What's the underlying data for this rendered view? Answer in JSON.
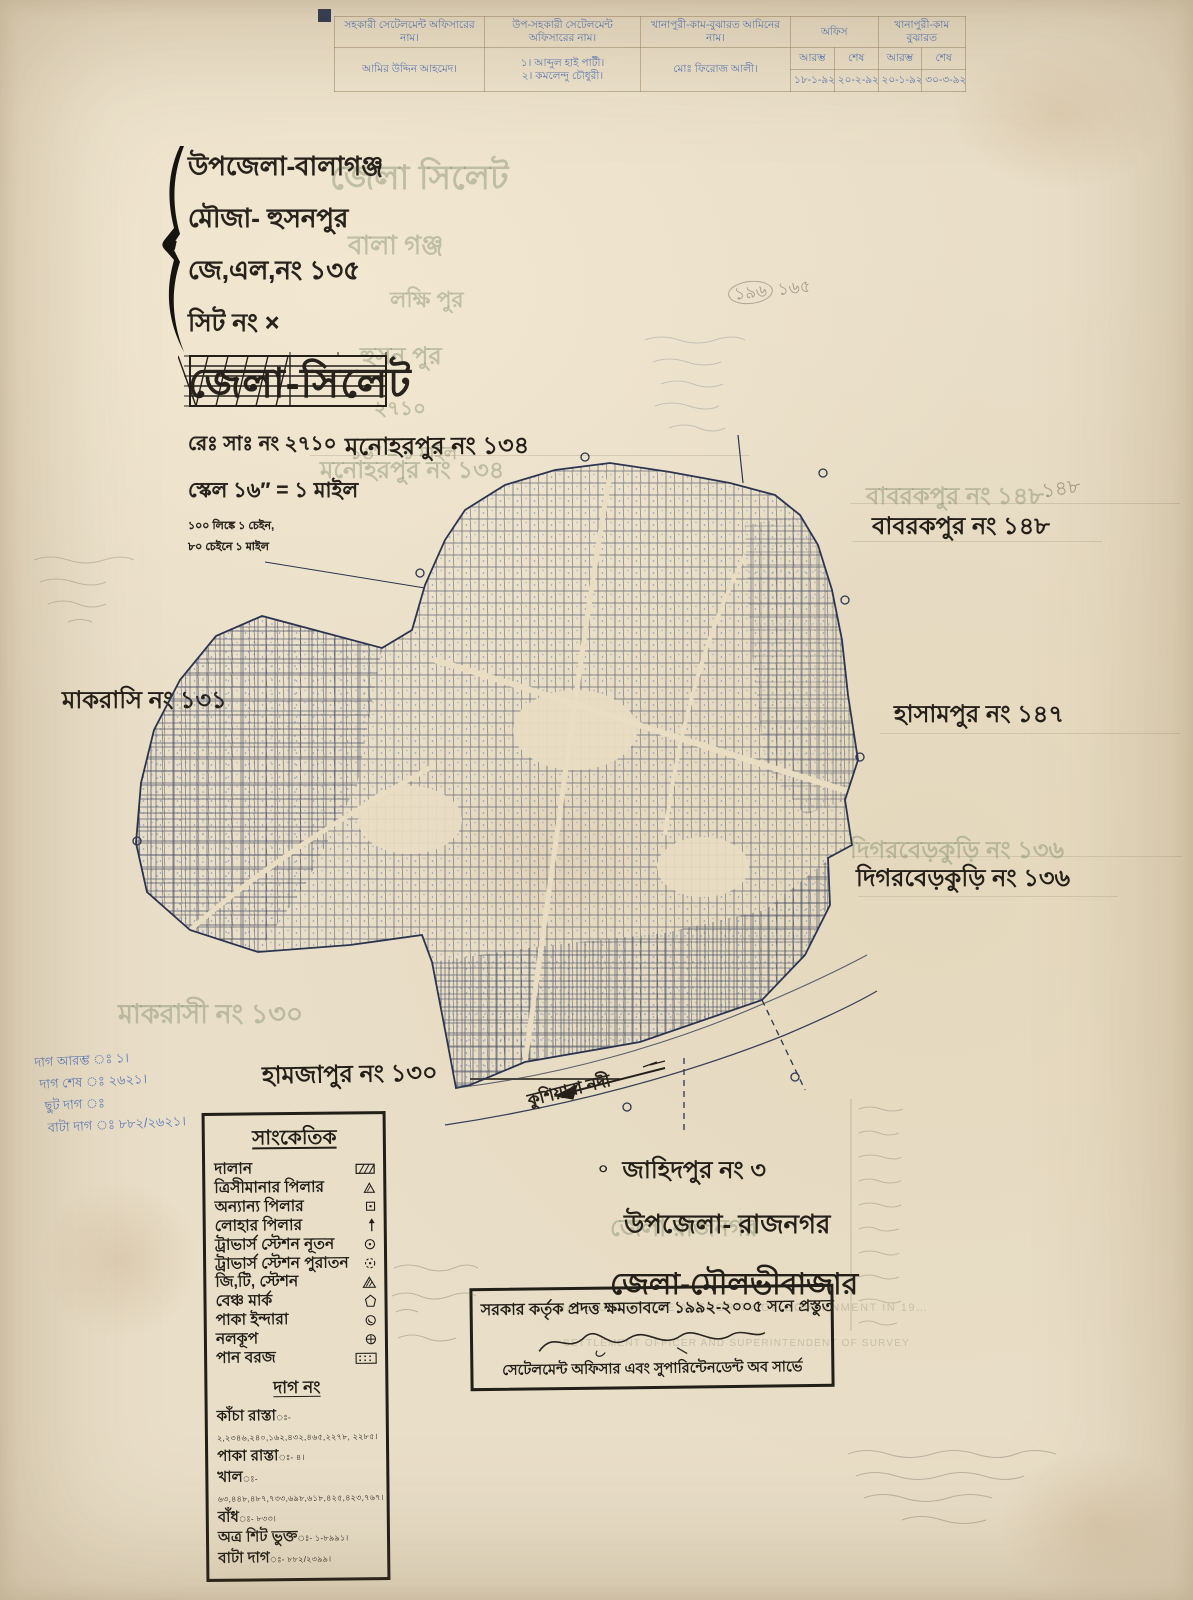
{
  "header_table": {
    "col1_label": "সহকারী সেটেলমেন্ট অফিসারের নাম।",
    "col2_label": "উপ-সহকারী সেটেলমেন্ট অফিসারের নাম।",
    "col3_label": "খানাপুরী-কাম-বুঝারত আমিনের নাম।",
    "office_label": "অফিস",
    "khana_label": "খানাপুরী-কাম বুঝারত",
    "start_label": "আরম্ভ",
    "end_label": "শেষ",
    "col1_value": "আমির উদ্দিন আহমেদ।",
    "col2_value1": "১। আব্দুল হাই পাটী।",
    "col2_value2": "২। কমলেন্দু চৌধুরী।",
    "col3_value": "মোঃ ফিরোজ আলী।",
    "office_start": "১৮-১-৯২",
    "office_end": "২০-২-৯২",
    "khana_start": "২০-১-৯২",
    "khana_end": "৩০-৩-৯২"
  },
  "title_block": {
    "upazila": "উপজেলা-বালাগঞ্জ",
    "mouza": "মৌজা- হুসনপুর",
    "jl_no": "জে,এল,নং ১৩৫",
    "sheet_no": "সিট নং ×",
    "district": "জেলা-সিলেট",
    "re_sa_no": "রেঃ সাঃ নং ২৭১০",
    "scale": "স্কেল ১৬″ = ১ মাইল",
    "scale_note1": "১০০ লিঙ্কে ১ চেইন,",
    "scale_note2": "৮০ চেইনে ১ মাইল"
  },
  "neighbors": {
    "north": "মনোহরপুর নং ১৩৪",
    "northeast": "বাবরকপুর নং ১৪৮",
    "west": "মাকরাসি নং ১৩১",
    "east": "হাসামপুর নং ১৪৭",
    "southeast": "দিগরবেড়কুড়ি নং ১৩৬",
    "south": "হামজাপুর নং ১৩০"
  },
  "map": {
    "river_name": "কুশিয়ারা নদী"
  },
  "south_block": {
    "mark": "০",
    "line1": "জাহিদপুর নং ৩",
    "line2": "উপজেলা- রাজনগর",
    "line3": "জেলা-মৌলভীবাজার"
  },
  "legend": {
    "title": "সাংকেতিক",
    "items": [
      {
        "label": "দালান",
        "icon": "hatched-rect"
      },
      {
        "label": "ত্রিসীমানার পিলার",
        "icon": "triangle-outline"
      },
      {
        "label": "অন্যান্য পিলার",
        "icon": "square-dot"
      },
      {
        "label": "লোহার পিলার",
        "icon": "iron-pillar"
      },
      {
        "label": "ট্রাভার্স স্টেশন নূতন",
        "icon": "circle-dot"
      },
      {
        "label": "ট্রাভার্স স্টেশন পুরাতন",
        "icon": "circle-dot-dashed"
      },
      {
        "label": "জি,টি, স্টেশন",
        "icon": "triangle-hatched"
      },
      {
        "label": "বেঞ্চ মার্ক",
        "icon": "benchmark-pentagon"
      },
      {
        "label": "পাকা ইন্দারা",
        "icon": "circle-crescent"
      },
      {
        "label": "নলকূপ",
        "icon": "circle-cross"
      },
      {
        "label": "পান বরজ",
        "icon": "dotted-rect"
      }
    ],
    "dag_title": "দাগ নং",
    "dag_items": [
      {
        "label": "কাঁচা রাস্তা",
        "value": "ঃ- ২,২৩৪৬,২৪০,১৬২,৪৩২,৪৬৫,২২৭৮, ২২৮৫।"
      },
      {
        "label": "পাকা রাস্তা",
        "value": "ঃ- ৪।"
      },
      {
        "label": "খাল",
        "value": "ঃ- ৬৩,৪৪৮,৪৮৭,৭৩৩,৬৯৮,৬১৮,৪২৫,৪২৩,৭৬৭।"
      },
      {
        "label": "বাঁধ",
        "value": "ঃ- ৮৩৩।"
      },
      {
        "label": "অত্র শিট ভুক্ত",
        "value": "ঃ- ১-৮৯৯১।"
      },
      {
        "label": "বাটা দাগ",
        "value": "ঃ- ৮৮২/২৩৯৯।"
      }
    ]
  },
  "stamp": {
    "line1": "সরকার কর্তৃক প্রদত্ত ক্ষমতাবলে ১৯৯২-২০০৫ সনে প্রস্তুত",
    "line3": "সেটেলমেন্ট অফিসার এবং সুপারিন্টেনডেন্ট অব সার্ভে"
  },
  "margin_notes": {
    "lines": [
      "দাগ আরম্ভ ঃ ১।",
      "দাগ শেষ ঃ ২৬২১।",
      "ছুট দাগ ঃ",
      "বাটা দাগ ঃ ৮৮২/২৬২১।"
    ]
  },
  "ghosts": {
    "title_lines": [
      "জেলা  সিলেট",
      "বালা গঞ্জ",
      "লক্ষি পুর",
      "হুসন পুর",
      "২৭১০",
      "১৬″ = ১ মাইল"
    ],
    "west_large": "মাকরাসী নং ১৩০",
    "rajnagar": "জেলা রাজনগর",
    "stamp_en1": "MADE UNDER THE AUTHORITY OF GOVERNMENT IN 19…",
    "stamp_en2": "SETTLEMENT OFFICER AND SUPERINTENDENT OF SURVEY",
    "pencil_165": "১৬৫",
    "pencil_148": "১৪৮"
  },
  "colors": {
    "paper": "#e9dec8",
    "ink": "#241f18",
    "map_ink": "#2c3450",
    "blue_hand": "#5d7ab8"
  }
}
